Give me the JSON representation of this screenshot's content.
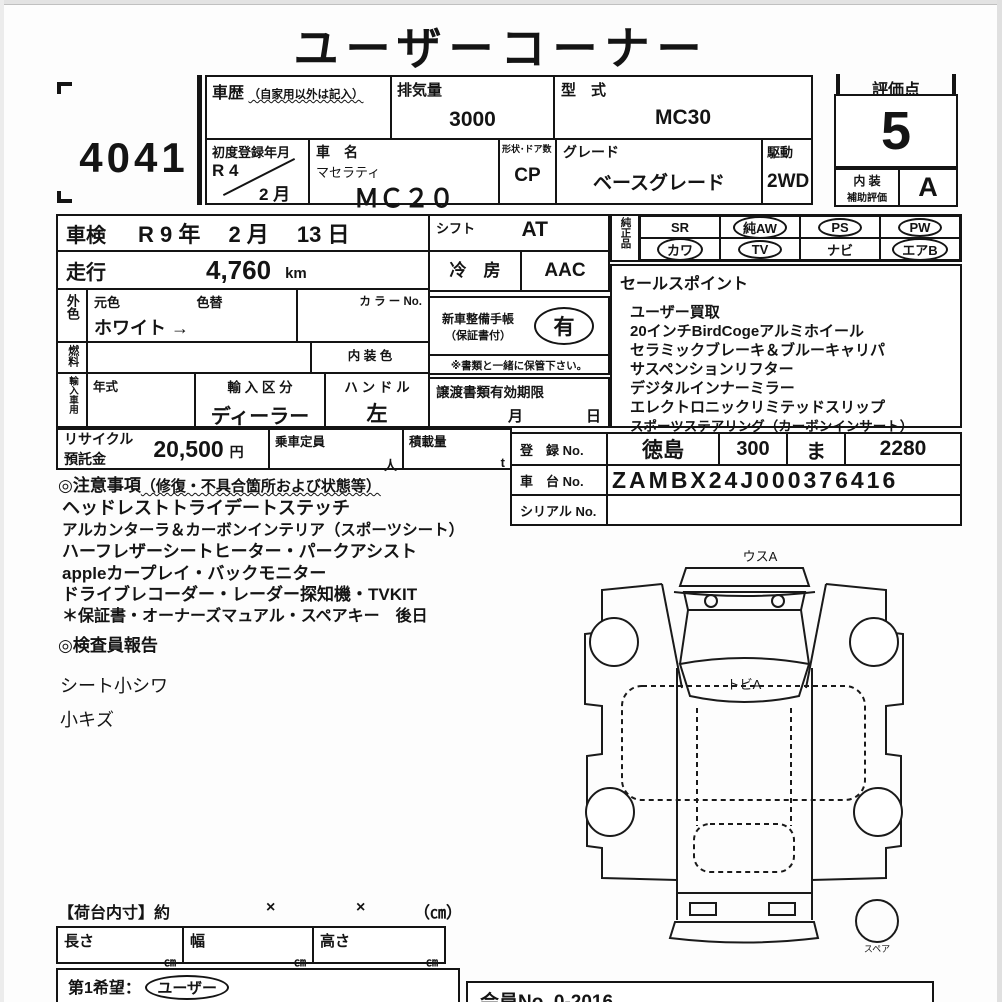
{
  "title": "ユーザーコーナー",
  "lot_no": "4041",
  "header": {
    "history_label": "車歴",
    "history_note": "（自家用以外は記入）",
    "displacement_label": "排気量",
    "displacement_value": "3000",
    "model_label": "型　式",
    "model_value": "MC30",
    "first_reg_label": "初度登録年月",
    "first_reg_era": "R 4",
    "first_reg_month": "2 月",
    "car_name_label": "車　名",
    "car_maker": "マセラティ",
    "car_name": "ＭＣ２０",
    "body_label": "形状･ドア数",
    "body_value": "CP",
    "grade_label": "グレード",
    "grade_value": "ベースグレード",
    "drive_label": "駆動",
    "drive_value": "2WD"
  },
  "score": {
    "label": "評価点",
    "value": "5",
    "interior_label_1": "内 装",
    "interior_label_2": "補助評価",
    "interior_value": "A"
  },
  "vehicle": {
    "shaken_label": "車検",
    "shaken_value": "R 9 年　 2 月　 13 日",
    "mileage_label": "走行",
    "mileage_value": "4,760",
    "mileage_unit": "km",
    "ext_color_label": "外色",
    "base_color_label": "元色",
    "repaint_label": "色替",
    "color_value": "ホワイト →",
    "color_no_label": "カ ラ ー No.",
    "fuel_label": "燃料",
    "interior_color_label": "内 装 色",
    "import_label": "輸入車用",
    "year_label": "年式",
    "import_class_label": "輸 入 区 分",
    "import_class_value": "ディーラー",
    "handle_label": "ハ ン ド ル",
    "handle_value": "左",
    "recycle_label_1": "リサイクル",
    "recycle_label_2": "預託金",
    "recycle_value": "20,500",
    "recycle_unit": "円",
    "capacity_label": "乗車定員",
    "capacity_unit": "人",
    "load_label": "積載量",
    "load_unit": "t"
  },
  "equip": {
    "shift_label": "シフト",
    "shift_value": "AT",
    "aircon_label": "冷　房",
    "aircon_value": "AAC",
    "record_book_label_1": "新車整備手帳",
    "record_book_label_2": "（保証書付）",
    "record_book_value": "有",
    "record_note": "※書類と一緒に保管下さい。",
    "transfer_label": "譲渡書類有効期限",
    "transfer_month": "月",
    "transfer_day": "日"
  },
  "genuine": {
    "label": "純正品",
    "items": [
      {
        "label": "SR",
        "circled": false
      },
      {
        "label": "純AW",
        "circled": true
      },
      {
        "label": "PS",
        "circled": true
      },
      {
        "label": "PW",
        "circled": true
      },
      {
        "label": "カワ",
        "circled": true
      },
      {
        "label": "TV",
        "circled": true
      },
      {
        "label": "ナビ",
        "circled": false
      },
      {
        "label": "エアB",
        "circled": true
      }
    ]
  },
  "sales_points": {
    "label": "セールスポイント",
    "lines": [
      "ユーザー買取",
      "20インチBirdCogeアルミホイール",
      "セラミックブレーキ＆ブルーキャリパ",
      "サスペンションリフター",
      "デジタルインナーミラー",
      "エレクトロニックリミテッドスリップ",
      "スポーツステアリング（カーボンインサート）"
    ]
  },
  "registration": {
    "reg_label": "登　録 No.",
    "reg_area": "徳島",
    "reg_class": "300",
    "reg_kana": "ま",
    "reg_number": "2280",
    "chassis_label": "車　台 No.",
    "chassis_value": "ZAMBX24J000376416",
    "serial_label": "シリアル No.",
    "serial_value": ""
  },
  "cautions": {
    "heading": "◎注意事項",
    "heading_note": "（修復・不具合箇所および状態等）",
    "lines": [
      "ヘッドレストトライデートステッチ",
      "アルカンターラ＆カーボンインテリア（スポーツシート）",
      "ハーフレザーシートヒーター・パークアシスト",
      "appleカープレイ・バックモニター",
      "ドライブレコーダー・レーダー探知機・TVKIT",
      "＊保証書・オーナーズマュアル・スペアキー　後日"
    ]
  },
  "inspector": {
    "heading": "◎検査員報告",
    "lines": [
      "シート小シワ",
      "小キズ"
    ]
  },
  "diagram": {
    "front_label": "ウスA",
    "windshield_label": "トビA",
    "spare_label": "スペア"
  },
  "cargo": {
    "heading": "【荷台内寸】約",
    "x1": "×",
    "x2": "×",
    "unit_note": "（㎝）",
    "length_label": "長さ",
    "width_label": "幅",
    "height_label": "高さ",
    "cm": "㎝"
  },
  "footer": {
    "wish_label": "第1希望：",
    "wish_value": "ユーザー",
    "member_no": "会員No. 0-2016"
  }
}
